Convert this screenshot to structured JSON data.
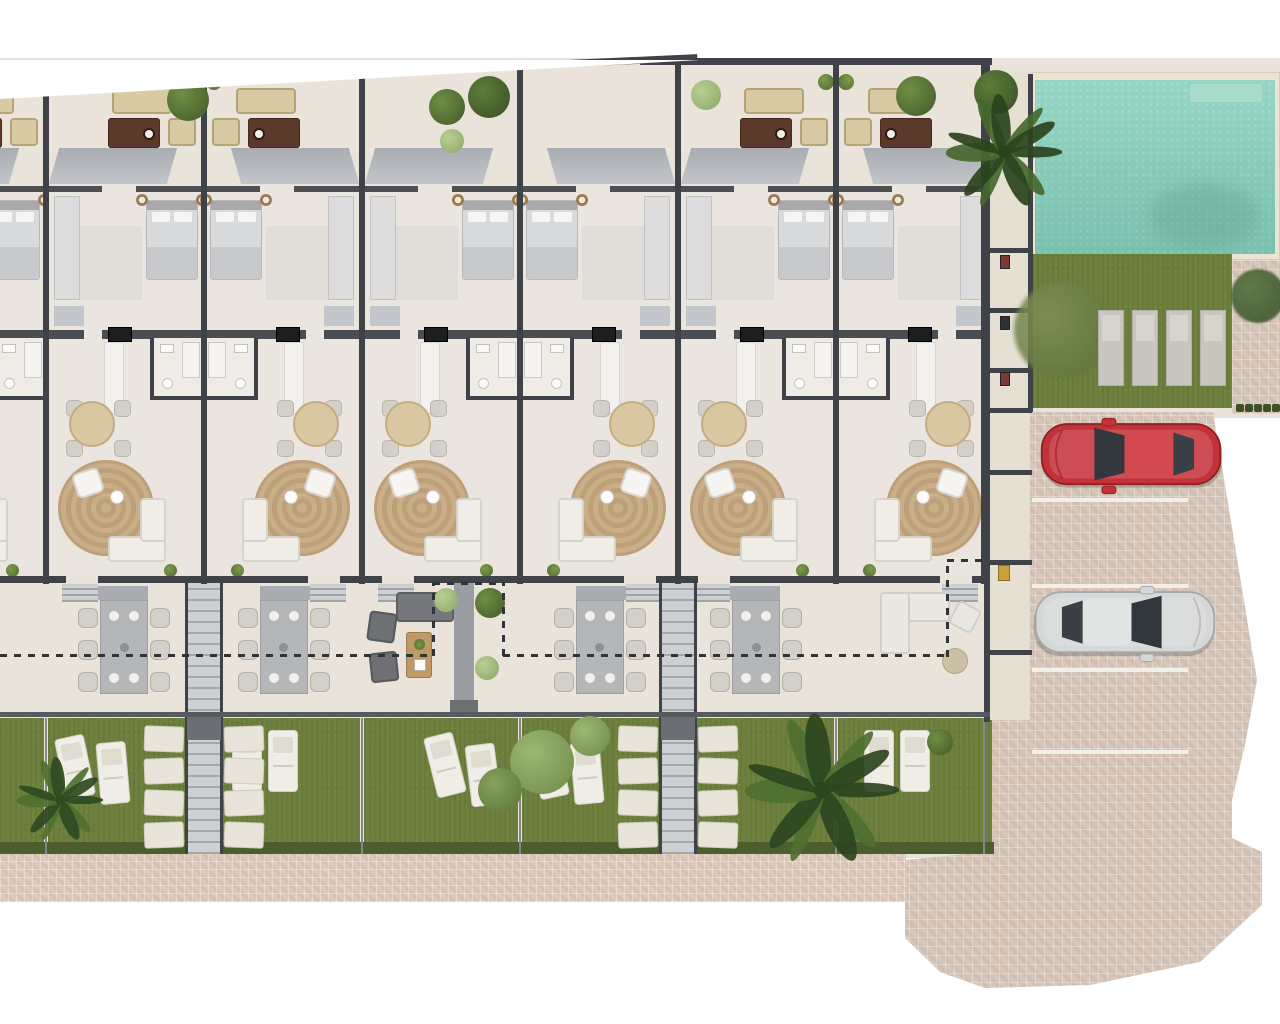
{
  "title": "Residential development site plan – top-down 3D render",
  "plan_type": "architectural-floor-plan",
  "visible_text": [],
  "palette": {
    "background": "#ffffff",
    "ground_beige": "#e9e3d9",
    "interior_floor": "#eae5df",
    "wall_dark": "#3f4247",
    "awning_gray": "#a9adb3",
    "grass_green": "#6d803d",
    "hedge_green": "#4c5e2e",
    "pool_water": "#8bd1bf",
    "pool_coping": "#ece4d1",
    "cobble_paving": "#d7c7ba",
    "sidewalk_paving": "#dccabc",
    "rug_tan_1": "#c9ae87",
    "rug_tan_2": "#bda079",
    "wood_tan": "#bf9a66",
    "sofa_brown": "#5b392b",
    "cushion_beige": "#d8cba3",
    "outdoor_table_gray": "#b5b6b8",
    "chair_light": "#d3d0c9",
    "white_furniture": "#efede6",
    "lounger_gray": "#c9c6bf",
    "car_red": "#c43239",
    "car_silver": "#d6d7d7",
    "glass_dark": "#31373d",
    "stone_slab": "#e9e4da",
    "corridor_gray": "#cdd0d2",
    "section_dash": "#2f3438"
  },
  "site": {
    "units": [
      {
        "id": "unit-0",
        "x": -112,
        "bed_side": "right",
        "terrace_top": "sofa-set",
        "bottom_terrace": "lounge-dark",
        "garden": "loungers-angled"
      },
      {
        "id": "unit-1",
        "x": 46,
        "bed_side": "right",
        "terrace_top": "sofa-set",
        "bottom_terrace": "dining",
        "garden": "loungers-angled"
      },
      {
        "id": "unit-2",
        "x": 204,
        "bed_side": "left",
        "terrace_top": "sofa-set",
        "bottom_terrace": "dining",
        "garden": "loungers-straight"
      },
      {
        "id": "unit-3",
        "x": 362,
        "bed_side": "right",
        "terrace_top": "trees",
        "bottom_terrace": "lounge-dark",
        "garden": "loungers-angled-bushes",
        "porch": true
      },
      {
        "id": "unit-4",
        "x": 520,
        "bed_side": "left",
        "terrace_top": "trees",
        "bottom_terrace": "dining",
        "garden": "loungers-angled"
      },
      {
        "id": "unit-5",
        "x": 678,
        "bed_side": "right",
        "terrace_top": "sofa-set",
        "bottom_terrace": "dining",
        "garden": "palm"
      },
      {
        "id": "unit-6",
        "x": 836,
        "bed_side": "left",
        "terrace_top": "sofa-set",
        "bottom_terrace": "lounge-light",
        "garden": "loungers-straight"
      }
    ],
    "corridor_positions": [
      204,
      678
    ],
    "amenities": {
      "swimming_pool": {
        "present": true,
        "shape": "rectangular"
      },
      "communal_lawn_sun_loungers": 4,
      "parking_spaces": 4,
      "cars": [
        {
          "name": "red-car",
          "color": "#c43239",
          "space_index": 1
        },
        {
          "name": "silver-car",
          "color": "#d6d7d7",
          "space_index": 3
        }
      ]
    },
    "annotations": {
      "section_cut_line": "dashed"
    }
  }
}
